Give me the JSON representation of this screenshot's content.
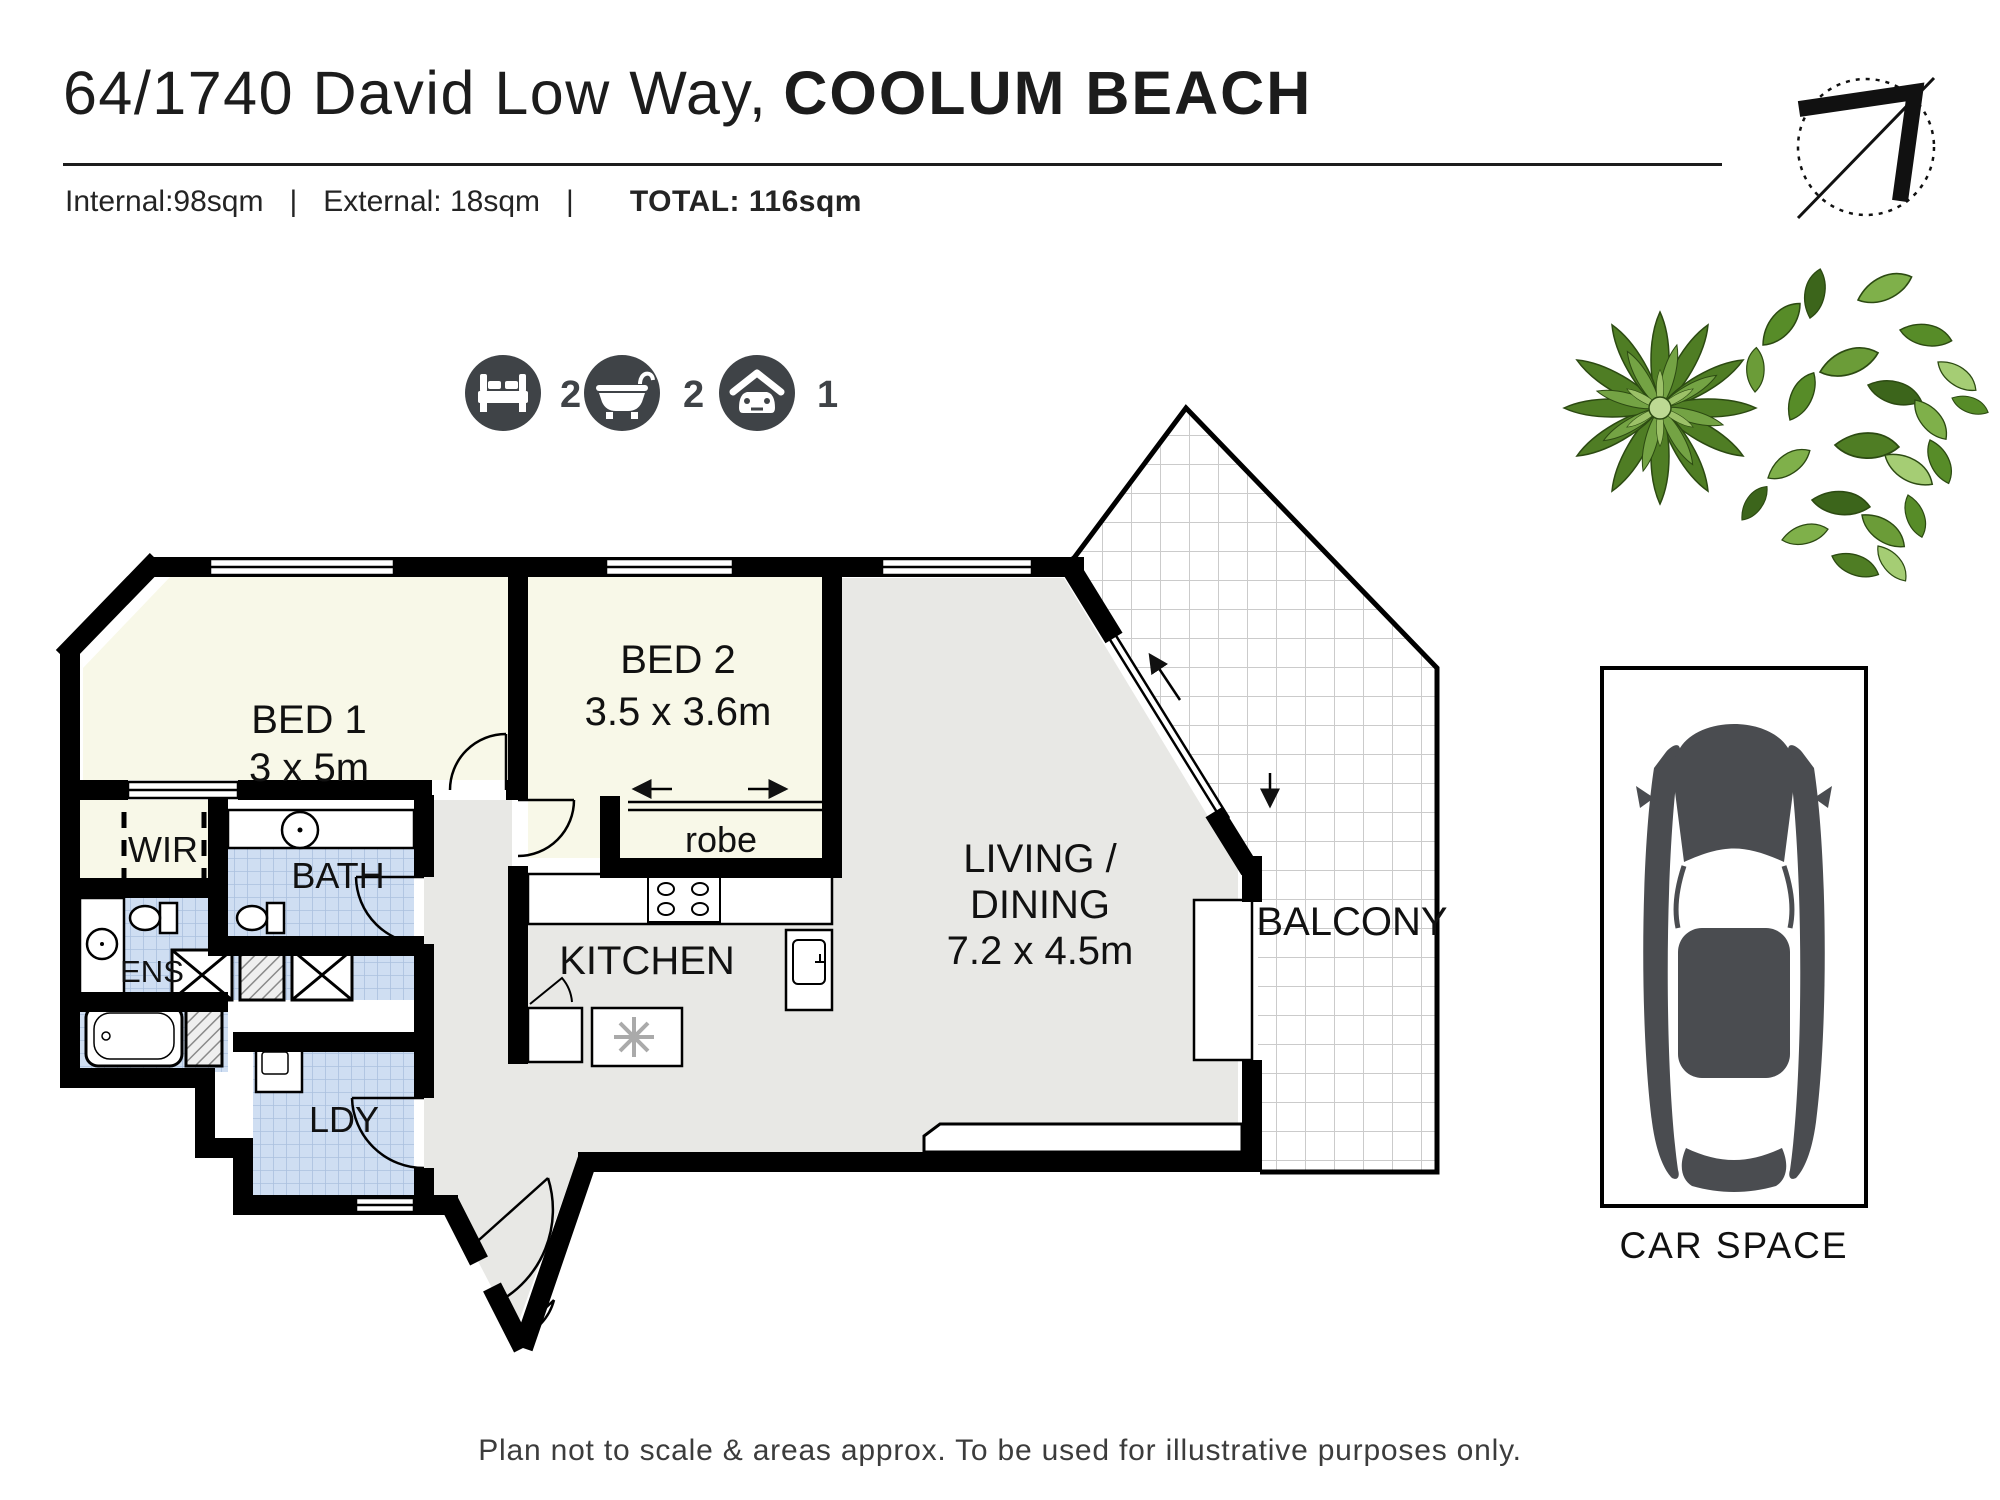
{
  "header": {
    "address": "64/1740 David Low Way,",
    "suburb": "COOLUM BEACH",
    "internal": "Internal:98sqm",
    "separator": "|",
    "external": "External: 18sqm",
    "total": "TOTAL: 116sqm"
  },
  "features": {
    "beds": "2",
    "baths": "2",
    "cars": "1"
  },
  "rooms": {
    "bed1": {
      "name": "BED 1",
      "dims": "3 x 5m"
    },
    "bed2": {
      "name": "BED 2",
      "dims": "3.5 x 3.6m"
    },
    "living": {
      "line1": "LIVING /",
      "line2": "DINING",
      "dims": "7.2 x 4.5m"
    },
    "kitchen": {
      "name": "KITCHEN"
    },
    "balcony": {
      "name": "BALCONY"
    },
    "robe": {
      "name": "robe"
    },
    "wir": {
      "name": "WIR"
    },
    "bath": {
      "name": "BATH"
    },
    "ens": {
      "name": "ENS"
    },
    "ldy": {
      "name": "LDY"
    },
    "car_space": {
      "name": "CAR SPACE"
    }
  },
  "footer": {
    "disclaimer": "Plan not to scale & areas approx. To be used for illustrative purposes only."
  },
  "colors": {
    "wall": "#000000",
    "room_cream": "#f8f8e8",
    "floor_grey": "#e8e8e5",
    "tile_blue": "#cfdef2",
    "tile_line": "#abc0de",
    "balcony_grid": "#cbcbcb",
    "icon_circle": "#3f4347",
    "plant_green": "#578c28",
    "car_grey": "#4a4c50"
  }
}
